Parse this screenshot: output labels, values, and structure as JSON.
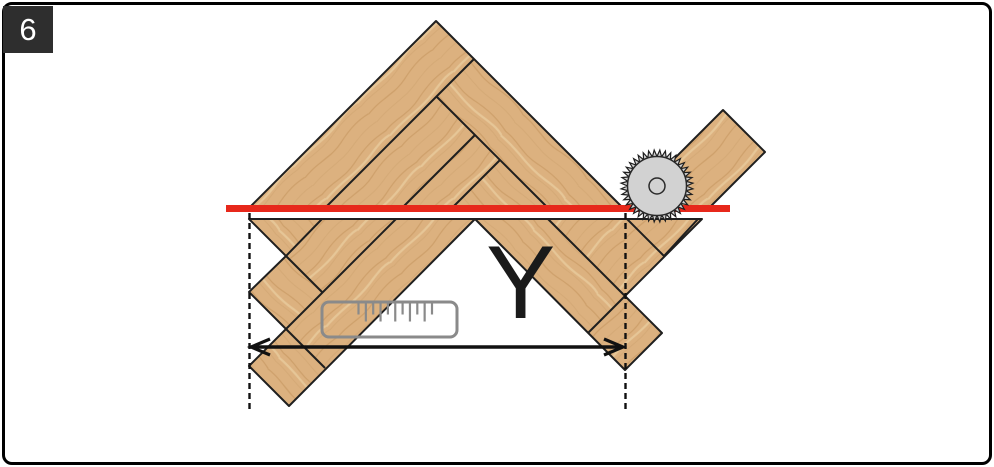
{
  "figure": {
    "step_number": "6",
    "dimension_label": "Y"
  },
  "icons": {
    "saw_blade": "circular-saw-blade-icon",
    "ruler": "ruler-icon",
    "dimension_arrow": "double-headed-arrow-icon",
    "cut_line": "cut-line"
  },
  "colors": {
    "cut_line_red": "#e7281b",
    "wood_base": "#dcb17f",
    "wood_grain": "#bf9058",
    "wood_grain_mid": "#caa06a",
    "wood_grain_light": "#ecd3a6",
    "outline_black": "#1f1f1f",
    "blade_gray": "#d2d2d2",
    "ruler_gray": "#8a8a8a",
    "badge_bg": "#2e2e2e",
    "badge_text": "#ffffff"
  }
}
